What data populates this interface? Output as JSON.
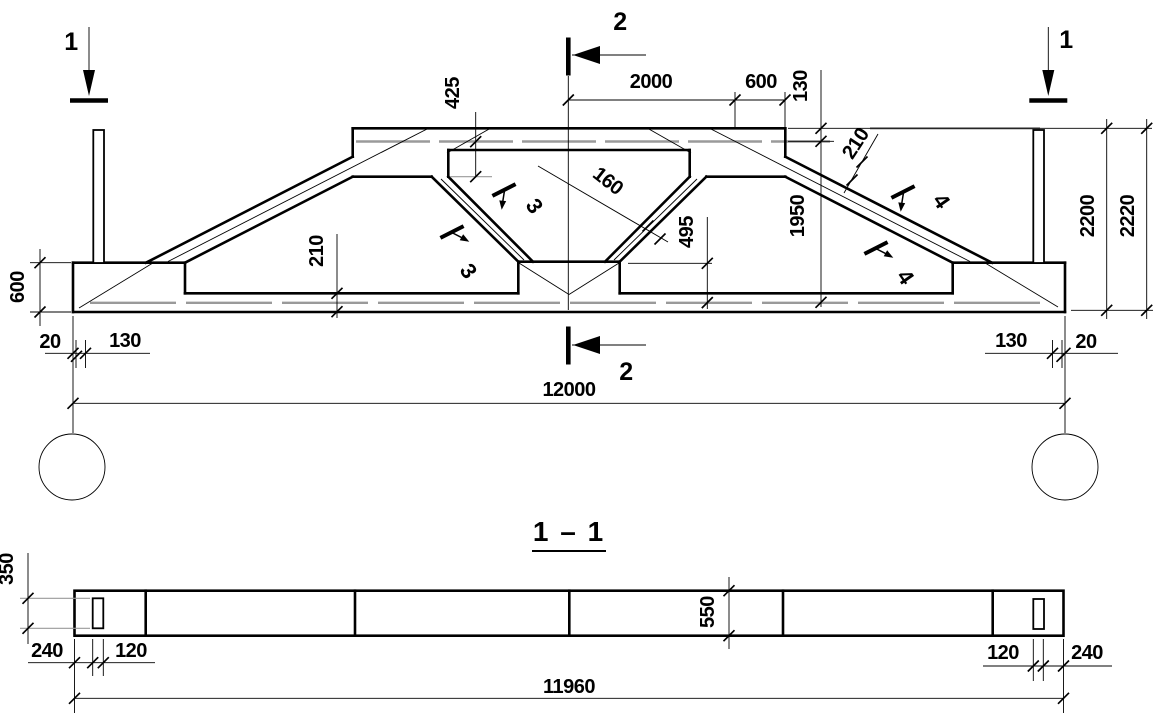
{
  "elevation": {
    "section_markers": {
      "s1": "1",
      "s2": "2"
    },
    "dims": {
      "d425": "425",
      "d2000": "2000",
      "d600_top": "600",
      "d130_slab": "130",
      "d1950": "1950",
      "d2200": "2200",
      "d2220": "2220",
      "d600_left": "600",
      "d210_bottom": "210",
      "d210_chord": "210",
      "d160": "160",
      "d495": "495",
      "d20_left": "20",
      "d130_left": "130",
      "d130_right": "130",
      "d20_right": "20",
      "d12000": "12000"
    },
    "weld_marks": {
      "m3a": "3",
      "m3b": "3",
      "m4a": "4",
      "m4b": "4"
    }
  },
  "section11": {
    "title": "1 – 1",
    "dims": {
      "d350": "350",
      "d240_left": "240",
      "d120_left": "120",
      "d550": "550",
      "d120_right": "120",
      "d240_right": "240",
      "d11960": "11960"
    }
  }
}
